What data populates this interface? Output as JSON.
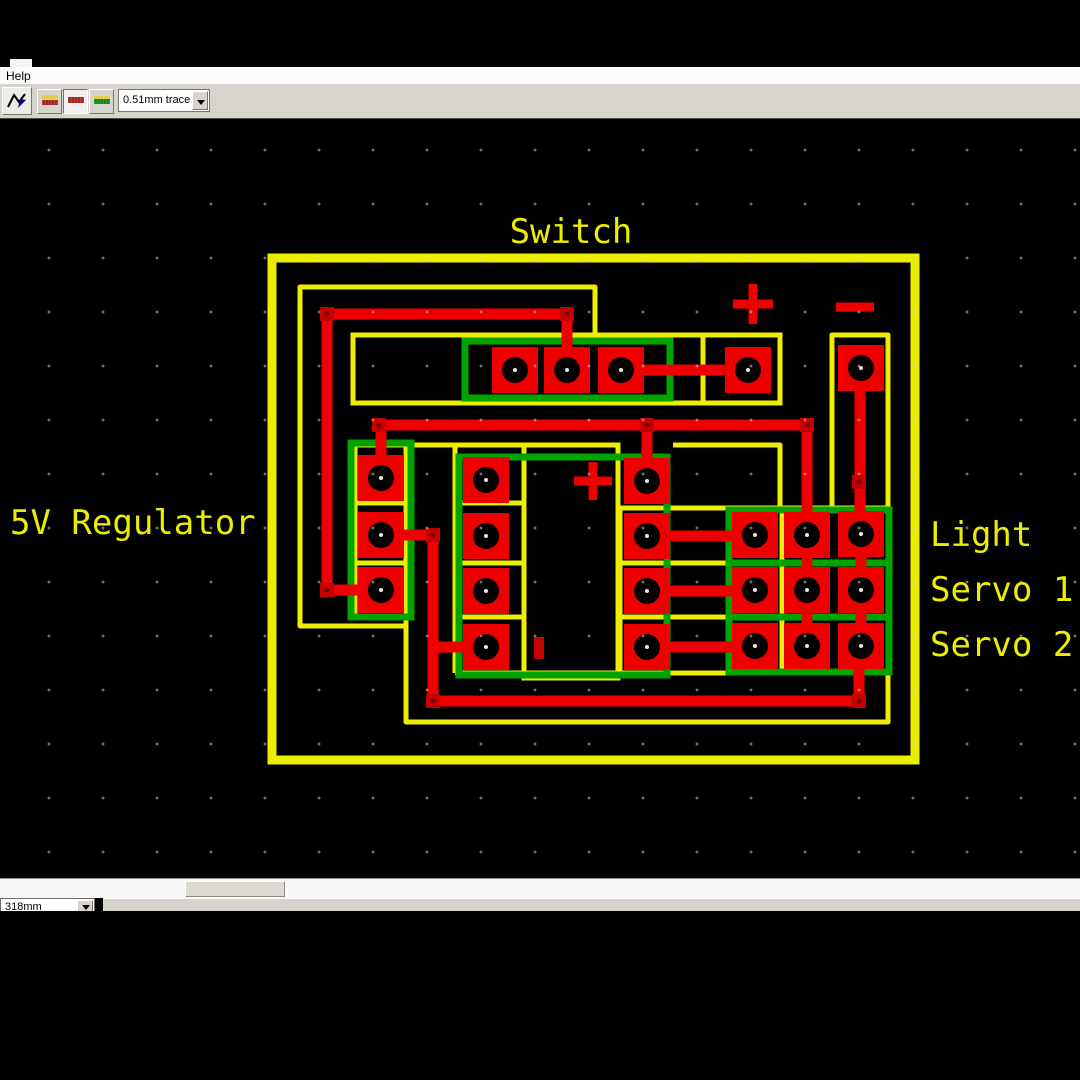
{
  "colors": {
    "silk": "#eded00",
    "trace": "#ee0000",
    "via_fill": "#c40000",
    "via_core": "#7a0000",
    "bottom": "#00a300",
    "pad": "#ee0000",
    "hole": "#000000"
  },
  "window": {
    "menu": {
      "items": [
        "Help"
      ]
    },
    "toolbar": {
      "buttons": [
        {
          "name": "route-trace-tool"
        },
        {
          "name": "layer-top-and-bottom"
        },
        {
          "name": "layer-top"
        },
        {
          "name": "layer-bottom"
        }
      ],
      "trace_width_value": "0.51mm trace"
    },
    "bottom": {
      "scale_value": "318mm"
    }
  },
  "pcb": {
    "board": {
      "x": 272,
      "y": 258,
      "w": 643,
      "h": 502,
      "stroke": 9
    },
    "labels": [
      {
        "text": "Switch",
        "x": 571,
        "y": 243,
        "anchor": "middle"
      },
      {
        "text": "5V Regulator",
        "x": 10,
        "y": 534,
        "anchor": "start"
      },
      {
        "text": "Light",
        "x": 930,
        "y": 546,
        "anchor": "start"
      },
      {
        "text": "Servo 1",
        "x": 930,
        "y": 601,
        "anchor": "start"
      },
      {
        "text": "Servo 2",
        "x": 930,
        "y": 656,
        "anchor": "start"
      }
    ],
    "silk": [
      {
        "pts": [
          [
            595,
            335
          ],
          [
            595,
            287
          ],
          [
            300,
            287
          ],
          [
            300,
            626
          ],
          [
            406,
            626
          ]
        ]
      },
      {
        "pts": [
          [
            406,
            445
          ],
          [
            406,
            722
          ],
          [
            888,
            722
          ],
          [
            888,
            335
          ],
          [
            832,
            335
          ],
          [
            832,
            508
          ],
          [
            888,
            508
          ]
        ]
      },
      {
        "rect": [
          353,
          335,
          427,
          68
        ]
      },
      {
        "pts": [
          [
            703,
            335
          ],
          [
            703,
            403
          ]
        ]
      },
      {
        "pts": [
          [
            355,
            445
          ],
          [
            620,
            445
          ]
        ]
      },
      {
        "pts": [
          [
            355,
            445
          ],
          [
            355,
            617
          ]
        ]
      },
      {
        "pts": [
          [
            355,
            503
          ],
          [
            406,
            503
          ]
        ]
      },
      {
        "pts": [
          [
            355,
            563
          ],
          [
            406,
            563
          ]
        ]
      },
      {
        "pts": [
          [
            355,
            617
          ],
          [
            406,
            617
          ]
        ]
      },
      {
        "pts": [
          [
            455,
            445
          ],
          [
            455,
            673
          ]
        ]
      },
      {
        "pts": [
          [
            455,
            503
          ],
          [
            524,
            503
          ]
        ]
      },
      {
        "pts": [
          [
            455,
            563
          ],
          [
            524,
            563
          ]
        ]
      },
      {
        "pts": [
          [
            455,
            617
          ],
          [
            524,
            617
          ]
        ]
      },
      {
        "rect": [
          524,
          445,
          94,
          233
        ]
      },
      {
        "pts": [
          [
            673,
            445
          ],
          [
            780,
            445
          ],
          [
            780,
            508
          ]
        ]
      },
      {
        "pts": [
          [
            620,
            508
          ],
          [
            620,
            673
          ]
        ]
      },
      {
        "pts": [
          [
            620,
            508
          ],
          [
            885,
            508
          ]
        ]
      },
      {
        "pts": [
          [
            620,
            563
          ],
          [
            885,
            563
          ]
        ]
      },
      {
        "pts": [
          [
            620,
            617
          ],
          [
            885,
            617
          ]
        ]
      },
      {
        "pts": [
          [
            782,
            508
          ],
          [
            782,
            673
          ]
        ]
      },
      {
        "pts": [
          [
            455,
            673
          ],
          [
            885,
            673
          ]
        ]
      }
    ],
    "bottom_layer": [
      {
        "rect": [
          465,
          341,
          205,
          57
        ]
      },
      {
        "rect": [
          351,
          443,
          60,
          174
        ]
      },
      {
        "rect": [
          459,
          457,
          208,
          218
        ]
      },
      {
        "rect": [
          729,
          510,
          160,
          162
        ]
      },
      {
        "pts": [
          [
            729,
            563
          ],
          [
            889,
            563
          ]
        ]
      },
      {
        "pts": [
          [
            729,
            617
          ],
          [
            889,
            617
          ]
        ]
      }
    ],
    "traces": [
      {
        "pts": [
          [
            327,
            314
          ],
          [
            567,
            314
          ],
          [
            567,
            372
          ]
        ]
      },
      {
        "pts": [
          [
            327,
            314
          ],
          [
            327,
            590
          ],
          [
            383,
            590
          ]
        ]
      },
      {
        "pts": [
          [
            619,
            370
          ],
          [
            750,
            370
          ]
        ]
      },
      {
        "pts": [
          [
            860,
            368
          ],
          [
            860,
            536
          ]
        ]
      },
      {
        "pts": [
          [
            379,
            425
          ],
          [
            807,
            425
          ]
        ]
      },
      {
        "pts": [
          [
            381,
            425
          ],
          [
            381,
            480
          ]
        ]
      },
      {
        "pts": [
          [
            647,
            425
          ],
          [
            647,
            483
          ]
        ]
      },
      {
        "pts": [
          [
            807,
            425
          ],
          [
            807,
            537
          ]
        ]
      },
      {
        "pts": [
          [
            381,
            535
          ],
          [
            433,
            535
          ],
          [
            433,
            701
          ],
          [
            859,
            701
          ],
          [
            859,
            644
          ]
        ]
      },
      {
        "pts": [
          [
            433,
            647
          ],
          [
            488,
            647
          ]
        ]
      },
      {
        "pts": [
          [
            647,
            536
          ],
          [
            755,
            536
          ]
        ]
      },
      {
        "pts": [
          [
            647,
            591
          ],
          [
            755,
            591
          ]
        ]
      },
      {
        "pts": [
          [
            647,
            647
          ],
          [
            755,
            647
          ]
        ]
      },
      {
        "pts": [
          [
            807,
            535
          ],
          [
            807,
            646
          ]
        ]
      },
      {
        "pts": [
          [
            861,
            534
          ],
          [
            861,
            646
          ]
        ]
      }
    ],
    "vias": [
      [
        327,
        314
      ],
      [
        567,
        314
      ],
      [
        327,
        590
      ],
      [
        379,
        425
      ],
      [
        647,
        425
      ],
      [
        807,
        425
      ],
      [
        433,
        535
      ],
      [
        433,
        701
      ],
      [
        859,
        701
      ],
      [
        859,
        482
      ]
    ],
    "pads": [
      [
        515,
        370
      ],
      [
        567,
        370
      ],
      [
        621,
        370
      ],
      [
        748,
        370
      ],
      [
        861,
        368
      ],
      [
        381,
        478
      ],
      [
        381,
        535
      ],
      [
        381,
        590
      ],
      [
        486,
        480
      ],
      [
        486,
        536
      ],
      [
        486,
        591
      ],
      [
        486,
        647
      ],
      [
        647,
        481
      ],
      [
        647,
        536
      ],
      [
        647,
        591
      ],
      [
        647,
        647
      ],
      [
        755,
        535
      ],
      [
        755,
        590
      ],
      [
        755,
        646
      ],
      [
        807,
        535
      ],
      [
        807,
        590
      ],
      [
        807,
        646
      ],
      [
        861,
        534
      ],
      [
        861,
        590
      ],
      [
        861,
        646
      ]
    ],
    "symbols": [
      {
        "type": "plus",
        "x": 753,
        "y": 304,
        "arm": 20,
        "t": 9
      },
      {
        "type": "minus",
        "x": 855,
        "y": 307,
        "arm": 19,
        "t": 9
      },
      {
        "type": "plus",
        "x": 593,
        "y": 481,
        "arm": 19,
        "t": 9
      },
      {
        "type": "bar",
        "x": 539,
        "y": 648,
        "w": 10,
        "h": 22
      }
    ],
    "pad_size": 46,
    "hole_r": 13,
    "trace_w": 11,
    "silk_w": 5,
    "bottom_w": 7,
    "label_font_size": 34
  }
}
